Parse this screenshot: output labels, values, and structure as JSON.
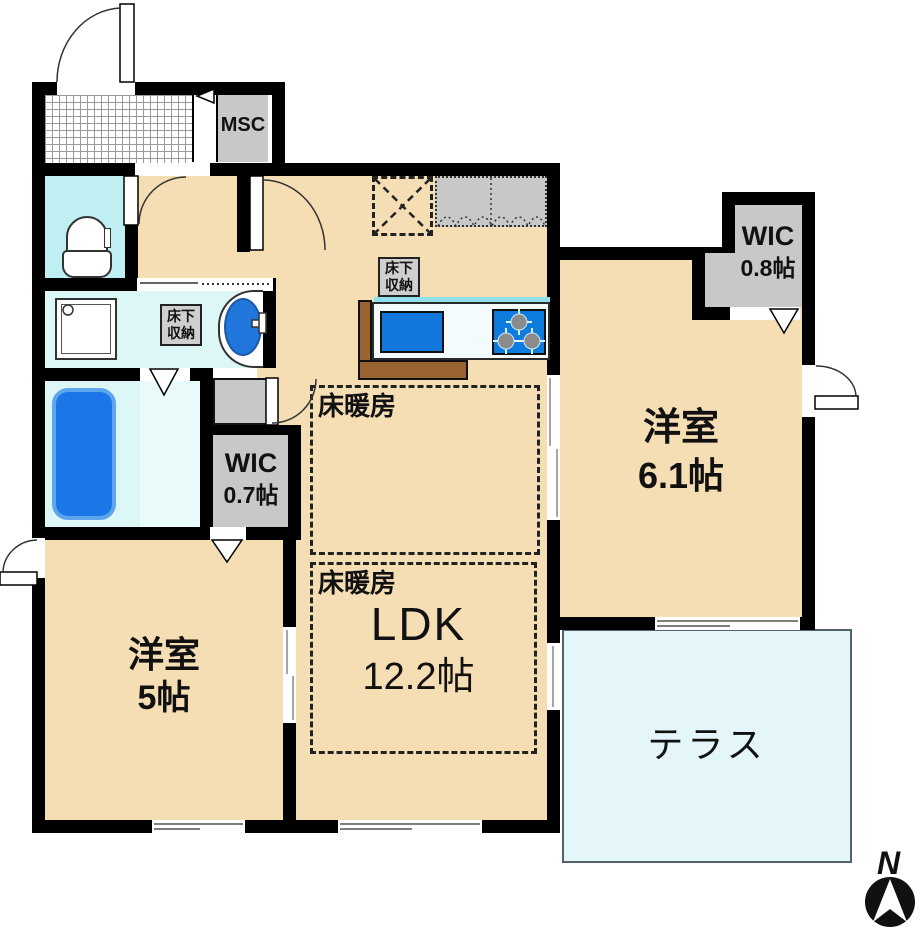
{
  "rooms": {
    "entrance_closet": {
      "label": "MSC"
    },
    "wic_right": {
      "name": "WIC",
      "size": "0.8帖"
    },
    "wic_left": {
      "name": "WIC",
      "size": "0.7帖"
    },
    "bedroom_right": {
      "name": "洋室",
      "size": "6.1帖"
    },
    "bedroom_left": {
      "name": "洋室",
      "size": "5帖"
    },
    "ldk": {
      "name": "LDK",
      "size": "12.2帖"
    },
    "terrace": {
      "name": "テラス"
    }
  },
  "annotations": {
    "floor_heating": "床暖房",
    "underfloor_storage": {
      "line1": "床下",
      "line2": "収納"
    },
    "compass_north": "N"
  },
  "colors": {
    "wall": "#000000",
    "room_floor": "#F5DDB4",
    "wet_area_floor": "#DDF7F7",
    "toilet_floor": "#BFEFF2",
    "terrace": "#E4F6FA",
    "storage_gray": "#C8C8C8",
    "fixture_blue": "#1278DE",
    "bathtub_blue": "#1B76E8",
    "counter_brown": "#9A6430"
  }
}
